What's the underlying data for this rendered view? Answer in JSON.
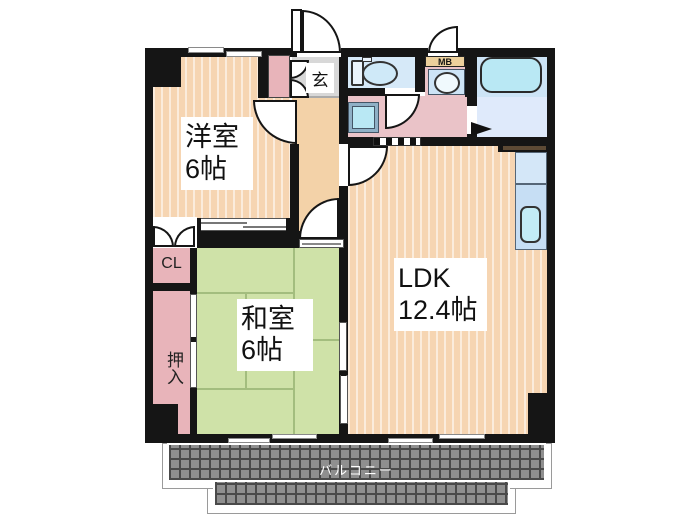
{
  "title": "apartment-floor-plan",
  "labels": {
    "youshitsu": {
      "name": "洋室",
      "size": "6帖"
    },
    "washitsu": {
      "name": "和室",
      "size": "6帖"
    },
    "ldk": {
      "name": "LDK",
      "size": "12.4帖"
    },
    "closet": "CL",
    "oshiire": "押入",
    "genkan": "玄",
    "meter_box": "MB",
    "balcony": "バルコニー"
  },
  "colors": {
    "wall": "#151515",
    "flooring": "#f6d5b2",
    "hallway": "#f3d2a8",
    "tatami": "#cfe2a8",
    "tatami_line": "#a3bd7e",
    "closet_pink": "#e8b4ba",
    "washroom_pink": "#eac3c8",
    "entry_gray": "#d8d8d8",
    "water_blue": "#cde4f6",
    "fixture_cyan": "#b9e8f4",
    "bath_floor": "#dfeafb",
    "counter_blue": "#c6def4",
    "mb_tan": "#ecd09c",
    "balcony_gray": "#8f8f8f",
    "balcony_line": "#4a4a4a",
    "lintel_brown": "#5d4a35"
  }
}
